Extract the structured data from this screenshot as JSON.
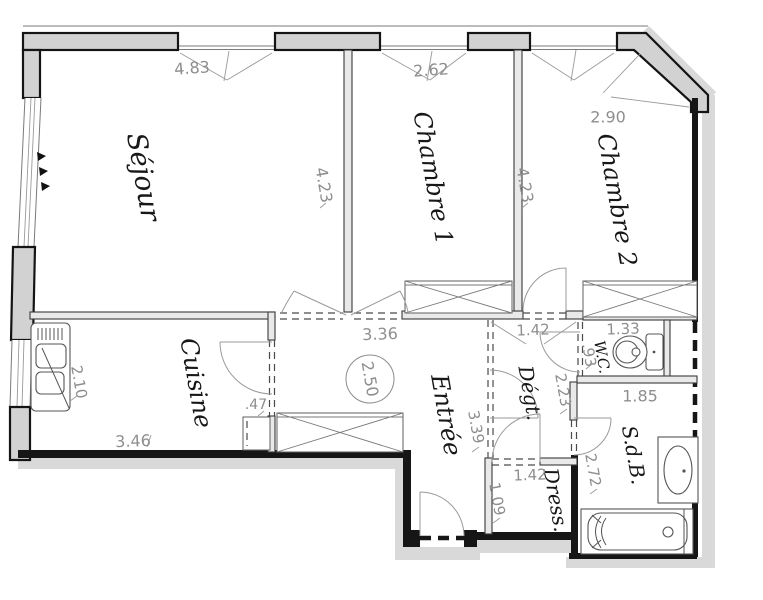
{
  "plan": {
    "kind": "apartment-floor-plan",
    "rooms": {
      "sejour": "Séjour",
      "chambre1": "Chambre 1",
      "chambre2": "Chambre 2",
      "cuisine": "Cuisine",
      "entree": "Entrée",
      "degt": "Dégt.",
      "wc": "W.C.",
      "sdb": "S.d.B.",
      "dress": "Dress."
    },
    "dims": {
      "sejour_w": "4.83",
      "ch1_w": "2.62",
      "ch2_w": "2.90",
      "sejour_h": "4.23",
      "ch1_h": "4.23",
      "hall_w": "3.36",
      "ceiling": "2.50",
      "degt_w": "1.42",
      "wc_w": "1.33",
      "wc_h": ".93",
      "degt_h": "2.23",
      "sdb_w": "1.85",
      "sdb_h": "2.72",
      "entree_h": "3.39",
      "dress_h": "1.09",
      "dress_w": "1.42",
      "cuisine_h": "2.10",
      "cuisine_w": "3.46",
      "duct_w": ".47"
    },
    "colors": {
      "wall_fill": "#d2d2d2",
      "partition_fill": "#e9e9e9",
      "shadow": "#d9d9d9",
      "dim_text": "#8e8e8e",
      "label_text": "#171717"
    }
  }
}
